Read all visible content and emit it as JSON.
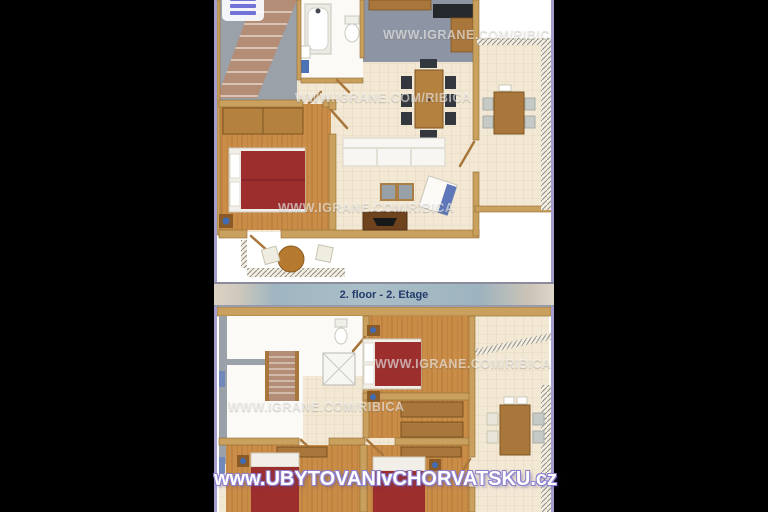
{
  "banner": {
    "label": "2. floor - 2. Etage"
  },
  "watermarks": {
    "site": "www.UBYTOVANIvCHORVATSKU.cz",
    "agency": "WWW.IGRANE.COM/RIBICA"
  },
  "icons": {
    "menu": "hamburger-menu-icon"
  },
  "colors": {
    "page_background": "#000000",
    "frame_border": "#a49ecf",
    "banner_text": "#243b6b",
    "banner_background": "#a3b8c2",
    "site_watermark": "#ffffff",
    "bed_cover": "#9c2e2e",
    "wood_floor": "#c98a45",
    "wall_tan": "#c9a05e",
    "tile_floor": "#f2e8d4"
  }
}
